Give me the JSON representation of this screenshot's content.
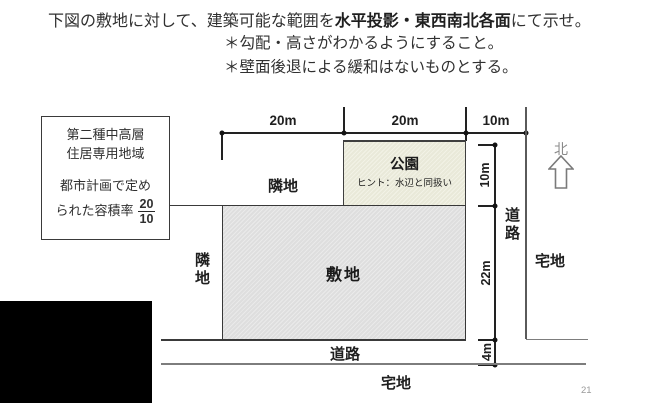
{
  "header": {
    "line1_pre": "下図の敷地に対して、建築可能な範囲を",
    "line1_bold": "水平投影・東西南北各面",
    "line1_post": "にて示せ。",
    "note1": "＊勾配・高さがわかるようにすること。",
    "note2": "＊壁面後退による緩和はないものとする。"
  },
  "zone_box": {
    "line1": "第二種中高層",
    "line2": "住居専用地域",
    "line3": "都市計画で定め",
    "line4": "られた容積率",
    "ratio_numerator": "20",
    "ratio_denominator": "10"
  },
  "dims": {
    "top_left": "20m",
    "top_center": "20m",
    "top_right": "10m",
    "park_depth": "10m",
    "site_depth": "22m",
    "road_width": "4m"
  },
  "labels": {
    "adjacent_land_top": "隣地",
    "adjacent_land_left": "隣地",
    "park": "公園",
    "park_hint": "ヒント：水辺と同扱い",
    "site": "敷地",
    "road_right": "道路",
    "road_bottom": "道路",
    "residential_right": "宅地",
    "residential_bottom": "宅地",
    "north": "北"
  },
  "page_number": "21",
  "colors": {
    "diagram_line": "#3a3a3a",
    "dim_line": "#222222",
    "gray_line": "#7d7d7d",
    "site_fill": "#e3e3e3",
    "park_fill": "#f0f0e3",
    "north_text": "#8a8a8a",
    "page_number": "#9a9a9a"
  }
}
